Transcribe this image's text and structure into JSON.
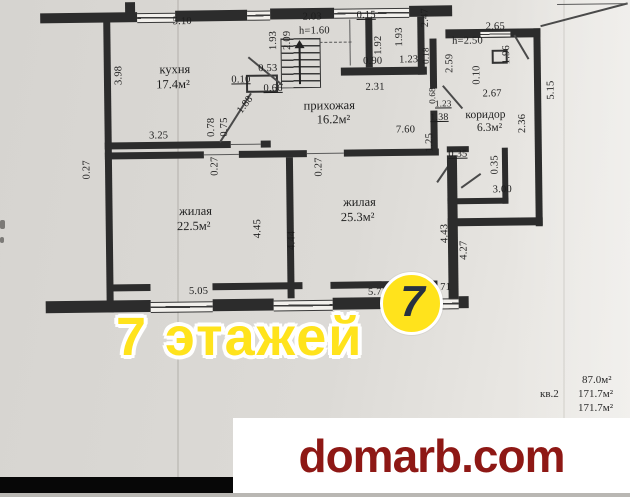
{
  "plan": {
    "rooms": [
      {
        "name": "кухня",
        "area": "17.4м²"
      },
      {
        "name": "прихожая",
        "area": "16.2м²"
      },
      {
        "name": "жилая",
        "area": "22.5м²"
      },
      {
        "name": "жилая",
        "area": "25.3м²"
      },
      {
        "name": "коридор",
        "area": "6.3м²"
      }
    ],
    "dims": [
      "5.10",
      "3.98",
      "0.10",
      "0.53",
      "0.66",
      "1.88",
      "0.78",
      "0.75",
      "3.25",
      "0.27",
      "2.03",
      "h=1.60",
      "1.93",
      "2.09",
      "0.15",
      "1.92",
      "1.93",
      "0.90",
      "1.23",
      "2.31",
      "7.60",
      "2.47",
      "0.18",
      "2.59",
      "0.68",
      "1.23",
      "1.38",
      "1.25",
      "2.65",
      "h=2.50",
      "1.96",
      "0.10",
      "2.67",
      "5.15",
      "2.36",
      "0.35",
      "0.35",
      "3.00",
      "0.27",
      "0.27",
      "4.45",
      "4.44",
      "4.43",
      "4.27",
      "5.05",
      "5.71",
      "2.71"
    ]
  },
  "watermark": {
    "text": "7 этажей",
    "logo_digit": "7",
    "yellow": "#ffe31c"
  },
  "areas_note": {
    "unit_label": "кв.2",
    "line1": "87.0м²",
    "line2": "171.7м²",
    "line3": "171.7м²"
  },
  "footer": {
    "site": "domarb.com",
    "red": "#8e1815"
  }
}
